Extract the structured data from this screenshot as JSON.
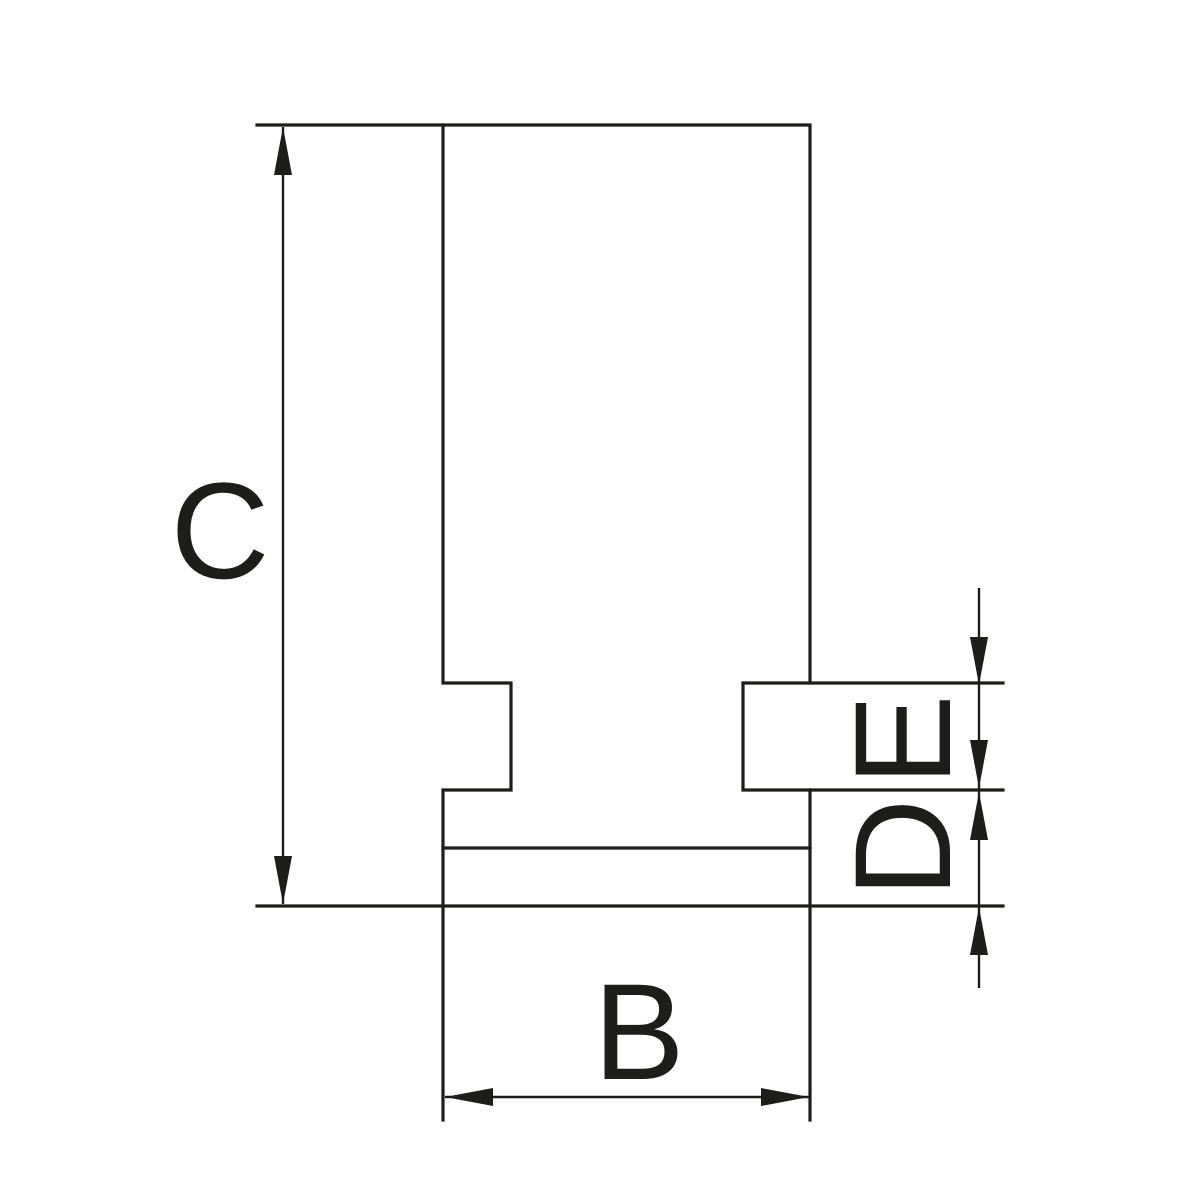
{
  "diagram": {
    "type": "technical-dimension-drawing",
    "background_color": "#ffffff",
    "line_color": "#1d1d1b",
    "labels": {
      "height_left": "C",
      "width_bottom": "B",
      "right_upper": "E",
      "right_lower": "D"
    }
  }
}
